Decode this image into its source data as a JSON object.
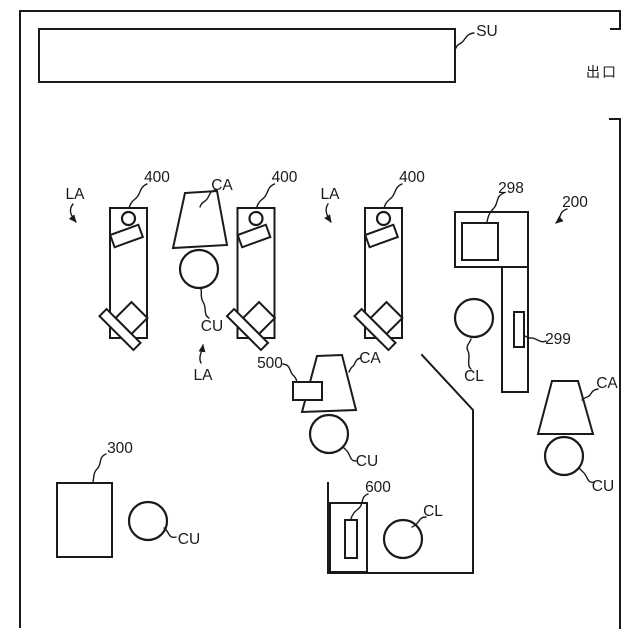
{
  "figure": {
    "background": "#ffffff",
    "line_color": "#1a1a1a",
    "labels": {
      "su": "SU",
      "exit": "出口",
      "la": "LA",
      "ca": "CA",
      "cu": "CU",
      "cl": "CL",
      "n200": "200",
      "n298": "298",
      "n299": "299",
      "n300": "300",
      "n400": "400",
      "n500": "500",
      "n600": "600"
    }
  }
}
